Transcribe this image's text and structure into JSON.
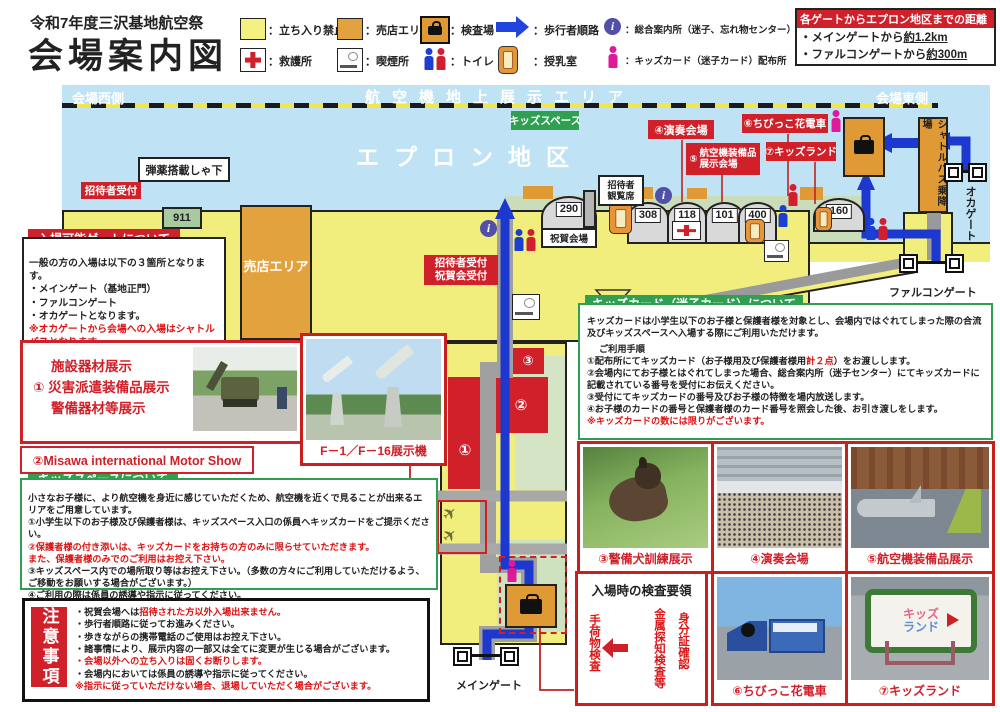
{
  "title": {
    "line1": "令和7年度三沢基地航空祭",
    "line2": "会場案内図"
  },
  "legend": {
    "row1": [
      {
        "icon": "no-entry-square",
        "label": "：立ち入り禁止"
      },
      {
        "icon": "vendor-square",
        "label": "：売店エリア"
      },
      {
        "icon": "inspection-briefcase",
        "label": "：検査場"
      },
      {
        "icon": "walk-route-arrow",
        "label": "：歩行者順路"
      },
      {
        "icon": "info-circle",
        "label": "：総合案内所（迷子、忘れ物センター）"
      }
    ],
    "row2": [
      {
        "icon": "first-aid-cross",
        "label": "：救護所"
      },
      {
        "icon": "smoking-area",
        "label": "：喫煙所"
      },
      {
        "icon": "toilet-figures",
        "label": "：トイレ"
      },
      {
        "icon": "nursing-room",
        "label": "：授乳室"
      },
      {
        "icon": "kids-card-person",
        "label": "：キッズカード（迷子カード）配布所"
      }
    ]
  },
  "distance": {
    "title": "各ゲートからエプロン地区までの距離",
    "l1a": "・メインゲートから",
    "l1b": "約1.2km",
    "l2a": "・ファルコンゲートから",
    "l2b": "約300m"
  },
  "map": {
    "west": "会場西側",
    "east": "会場東側",
    "air_display": "航空機地上展示エリア",
    "apron": "エプロン地区",
    "kids_space": "キッズスペース",
    "venue4": "④演奏会場",
    "venue5_no": "⑤",
    "venue5_l1": "航空機装備品",
    "venue5_l2": "展示会場",
    "venue6": "⑥ちびっこ花電車",
    "venue7": "⑦キッズランド",
    "ammo": "弾薬搭載しゃ下",
    "invite_reception": "招待者受付",
    "viewing_l1": "招待者",
    "viewing_l2": "観覧席",
    "celebration": "祝賀会場",
    "invite2_l1": "招待者受付",
    "invite2_l2": "祝賀会受付",
    "vendor": "売店エリア",
    "shuttle": "シャトルバス乗降場",
    "oka_gate": "オカゲート",
    "falcon_gate": "ファルコンゲート",
    "main_gate": "メインゲート",
    "num1": "①",
    "num2": "②",
    "num3": "③",
    "hangars": {
      "h911": "911",
      "h290": "290",
      "h308": "308",
      "h118": "118",
      "h101": "101",
      "h400": "400",
      "h160": "160"
    }
  },
  "gates_box": {
    "title": "入場可能ゲートについて",
    "l1": "一般の方の入場は以下の３箇所となります。",
    "l2": "・メインゲート（基地正門）",
    "l3": "・ファルコンゲート",
    "l4": "・オカゲートとなります。",
    "note": "※オカゲートから会場への入場はシャトルバスとなります。"
  },
  "facility_box": {
    "l1": "施設器材展示",
    "l2": "① 災害派遣装備品展示",
    "l3": "警備器材等展示"
  },
  "motor_show": "②Misawa international Motor Show",
  "kids_space_box": {
    "title": "キッズスペースについて",
    "l1": "小さなお子様に、より航空機を身近に感じていただくため、航空機を近くで見ることが出来るエリアをご用意しています。",
    "l2": "①小学生以下のお子様及び保護者様は、キッズスペース入口の係員へキッズカードをご提示ください。",
    "l3": "②保護者様の付き添いは、キッズカードをお持ちの方のみに限らせていただきます。",
    "l4": "また、保護者様のみでのご利用はお控え下さい。",
    "l5": "③キッズスペース内での場所取り等はお控え下さい。（多数の方々にご利用していただけるよう、ご移動をお願いする場合がございます。）",
    "l6": "④ご利用の際は係員の誘導や指示に従ってください。"
  },
  "kids_card_box": {
    "title": "キッズカード（迷子カード）について",
    "intro": "キッズカードは小学生以下のお子様と保護者様を対象とし、会場内ではぐれてしまった際の合流及びキッズスペースへ入場する際にご利用いただけます。",
    "steps_title": "ご利用手順",
    "s1a": "①配布所にてキッズカード（お子様用及び保護者様用",
    "s1b": "計２点",
    "s1c": "）をお渡しします。",
    "s2": "②会場内にてお子様とはぐれてしまった場合、総合案内所（迷子センター）にてキッズカードに記載されている番号を受付にお伝えください。",
    "s3": "③受付にてキッズカードの番号及びお子様の特徴を場内放送します。",
    "s4": "④お子様のカードの番号と保護者様のカード番号を照会した後、お引き渡しをします。",
    "note": "※キッズカードの数には限りがございます。"
  },
  "caution_box": {
    "title": "注意事項",
    "l1a": "・祝賀会場へは",
    "l1b": "招待された方以外入場出来ません。",
    "l2": "・歩行者順路に従ってお進みください。",
    "l3": "・歩きながらの携帯電話のご使用はお控え下さい。",
    "l4": "・諸事情により、展示内容の一部又は全てに変更が生じる場合がございます。",
    "l5": "・会場以外への立ち入りは固くお断りします。",
    "l6": "・会場内においては係員の誘導や指示に従ってください。",
    "l7": "※指示に従っていただけない場合、退場していただく場合がございます。"
  },
  "inspection_box": {
    "title": "入場時の検査要領",
    "v1": "身分証確認",
    "v2": "金属探知検査等",
    "v3": "手荷物検査"
  },
  "photos": {
    "f1": "F－1／F－16展示機",
    "p3": "③警備犬訓練展示",
    "p4": "④演奏会場",
    "p5": "⑤航空機装備品展示",
    "p6": "⑥ちびっこ花電車",
    "p7": "⑦キッズランド",
    "kidsland_sign1": "キッズ",
    "kidsland_sign2": "ランド"
  },
  "colors": {
    "accent_red": "#d0202a",
    "accent_green": "#2fa052",
    "route_blue": "#1d38cf",
    "zone_yellow": "#f2ee7e",
    "zone_orange": "#e2a23d",
    "apron_blue": "#bfe3f4"
  }
}
